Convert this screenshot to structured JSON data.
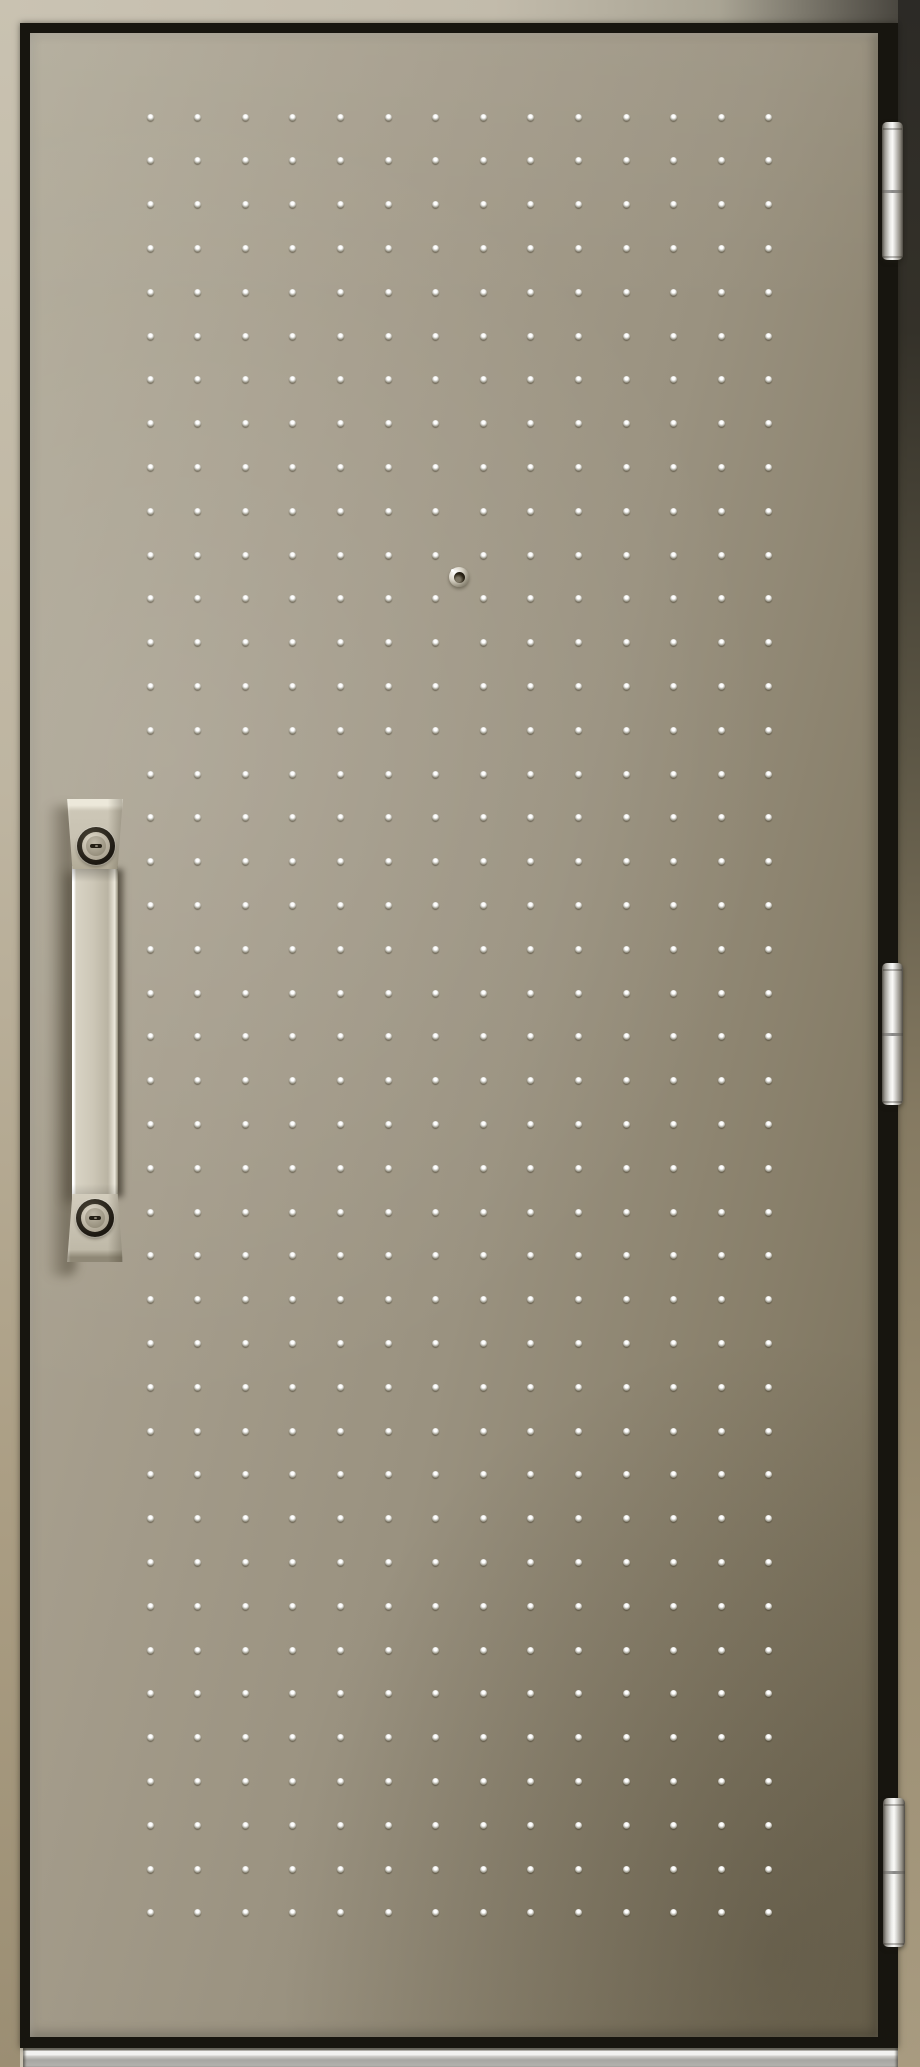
{
  "scene": {
    "subject": "steel-entrance-door-product-photo",
    "finish": "champagne-greige metal with embossed stud dot pattern",
    "visible_text": ""
  },
  "colors": {
    "frame_light": "#c9c2b1",
    "frame_tan": "#a2947a",
    "frame_dark": "#2f2d29",
    "outline_black": "#17150f",
    "door_light": "#b2ac9b",
    "door_mid": "#9a9280",
    "door_dark": "#756c56",
    "metal_bright": "#fafaf8",
    "handle_face": "#c8c2b2",
    "sill_bright": "#f2f2f0",
    "sill_gray": "#b5b4b0"
  },
  "dot_pattern": {
    "cols": 14,
    "rows": 42,
    "x0": 150,
    "y0": 117,
    "dx": 47.6,
    "dy": 43.8,
    "size": 7
  },
  "layout": {
    "frame-top": {
      "x": 0,
      "y": 0,
      "w": 898,
      "h": 23
    },
    "frame-left": {
      "x": 0,
      "y": 0,
      "w": 20,
      "h": 2067
    },
    "frame-right": {
      "x": 898,
      "y": 0,
      "w": 22,
      "h": 2067
    },
    "door-leaf": {
      "x": 20,
      "y": 23,
      "w": 878,
      "h": 2025
    },
    "threshold": {
      "x": 23,
      "y": 2048,
      "w": 875,
      "h": 19
    },
    "handle-shadow": {
      "x": 46,
      "y": 806,
      "w": 30,
      "h": 470
    },
    "handle-top-block": {
      "x": 66,
      "y": 799,
      "w": 58,
      "h": 70
    },
    "handle-grip-bar": {
      "x": 72,
      "y": 866,
      "w": 46,
      "h": 334
    },
    "handle-bottom-block": {
      "x": 66,
      "y": 1194,
      "w": 58,
      "h": 68
    },
    "top-lock": {
      "x": 77,
      "y": 827,
      "w": 38,
      "h": 38
    },
    "bottom-lock": {
      "x": 76,
      "y": 1199,
      "w": 38,
      "h": 38
    },
    "door-viewer": {
      "x": 449,
      "y": 567,
      "w": 20,
      "h": 20
    },
    "hinge-top": {
      "x": 882,
      "y": 122,
      "w": 21,
      "h": 138
    },
    "hinge-middle": {
      "x": 882,
      "y": 963,
      "w": 21,
      "h": 142
    },
    "hinge-bottom": {
      "x": 883,
      "y": 1798,
      "w": 22,
      "h": 149
    }
  }
}
